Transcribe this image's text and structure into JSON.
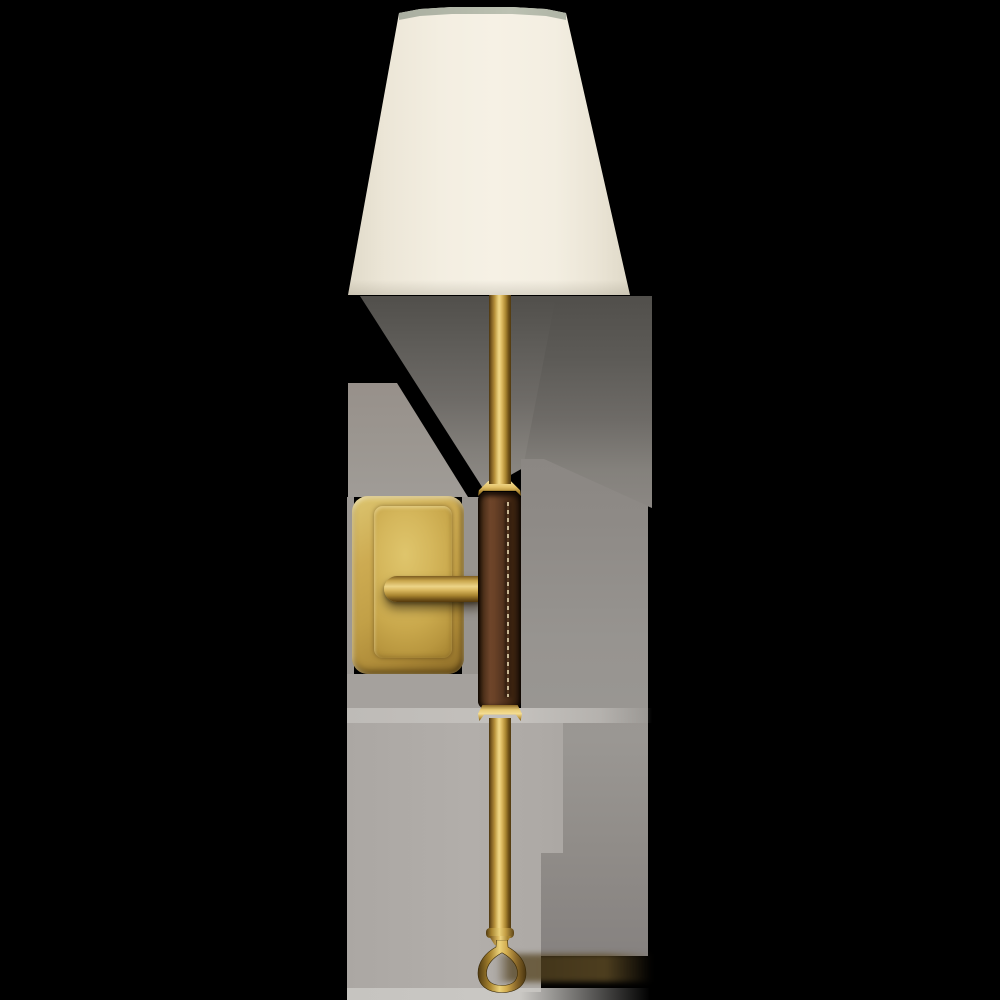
{
  "page": {
    "background": "#000000",
    "canvas": "1000x1000",
    "description": "Product photograph of a tall single-light wall sconce shown against a black background with soft gray photo shadow remnants"
  },
  "product": {
    "name": "Tail wall sconce",
    "materials": "hand-rubbed antique brass, saddle leather, linen",
    "parts": {
      "shade": {
        "label": "tapered linen shade"
      },
      "shade_rim": {
        "label": "shade top rim"
      },
      "rod_upper": {
        "label": "upper brass stem"
      },
      "ferrule_top": {
        "label": "upper brass ferrule"
      },
      "leather": {
        "label": "saddle leather wrapped grip"
      },
      "stitch": {
        "label": "leather stitch seam"
      },
      "ferrule_bottom": {
        "label": "lower brass ferrule"
      },
      "rod_lower": {
        "label": "lower brass stem"
      },
      "flange": {
        "label": "stem end cap"
      },
      "cone": {
        "label": "finial taper"
      },
      "loop": {
        "label": "brass teardrop loop finial"
      },
      "backplate": {
        "label": "rectangular brass backplate"
      },
      "backplate_face": {
        "label": "backplate face panel"
      },
      "arm": {
        "label": "mounting arm"
      },
      "shadow": {
        "label": "soft photo shadow"
      }
    }
  },
  "colors": {
    "canvas-bg": "#000000",
    "shade-linen": "#f6f1e5",
    "shade-rim": "#b5baab",
    "brass-hi": "#f0d683",
    "brass-mid": "#b8923b",
    "brass-edge": "#4a350f",
    "plate-face-hi": "#dfc56c",
    "plate-face-dark": "#ad8b36",
    "leather-hi": "#6e452a",
    "leather-mid": "#5a3822",
    "stitch": "#c8b795",
    "matte-light": "#aba7a3",
    "matte-band": "#c4c1bd",
    "matte-bottom": "#c6c4c0"
  }
}
